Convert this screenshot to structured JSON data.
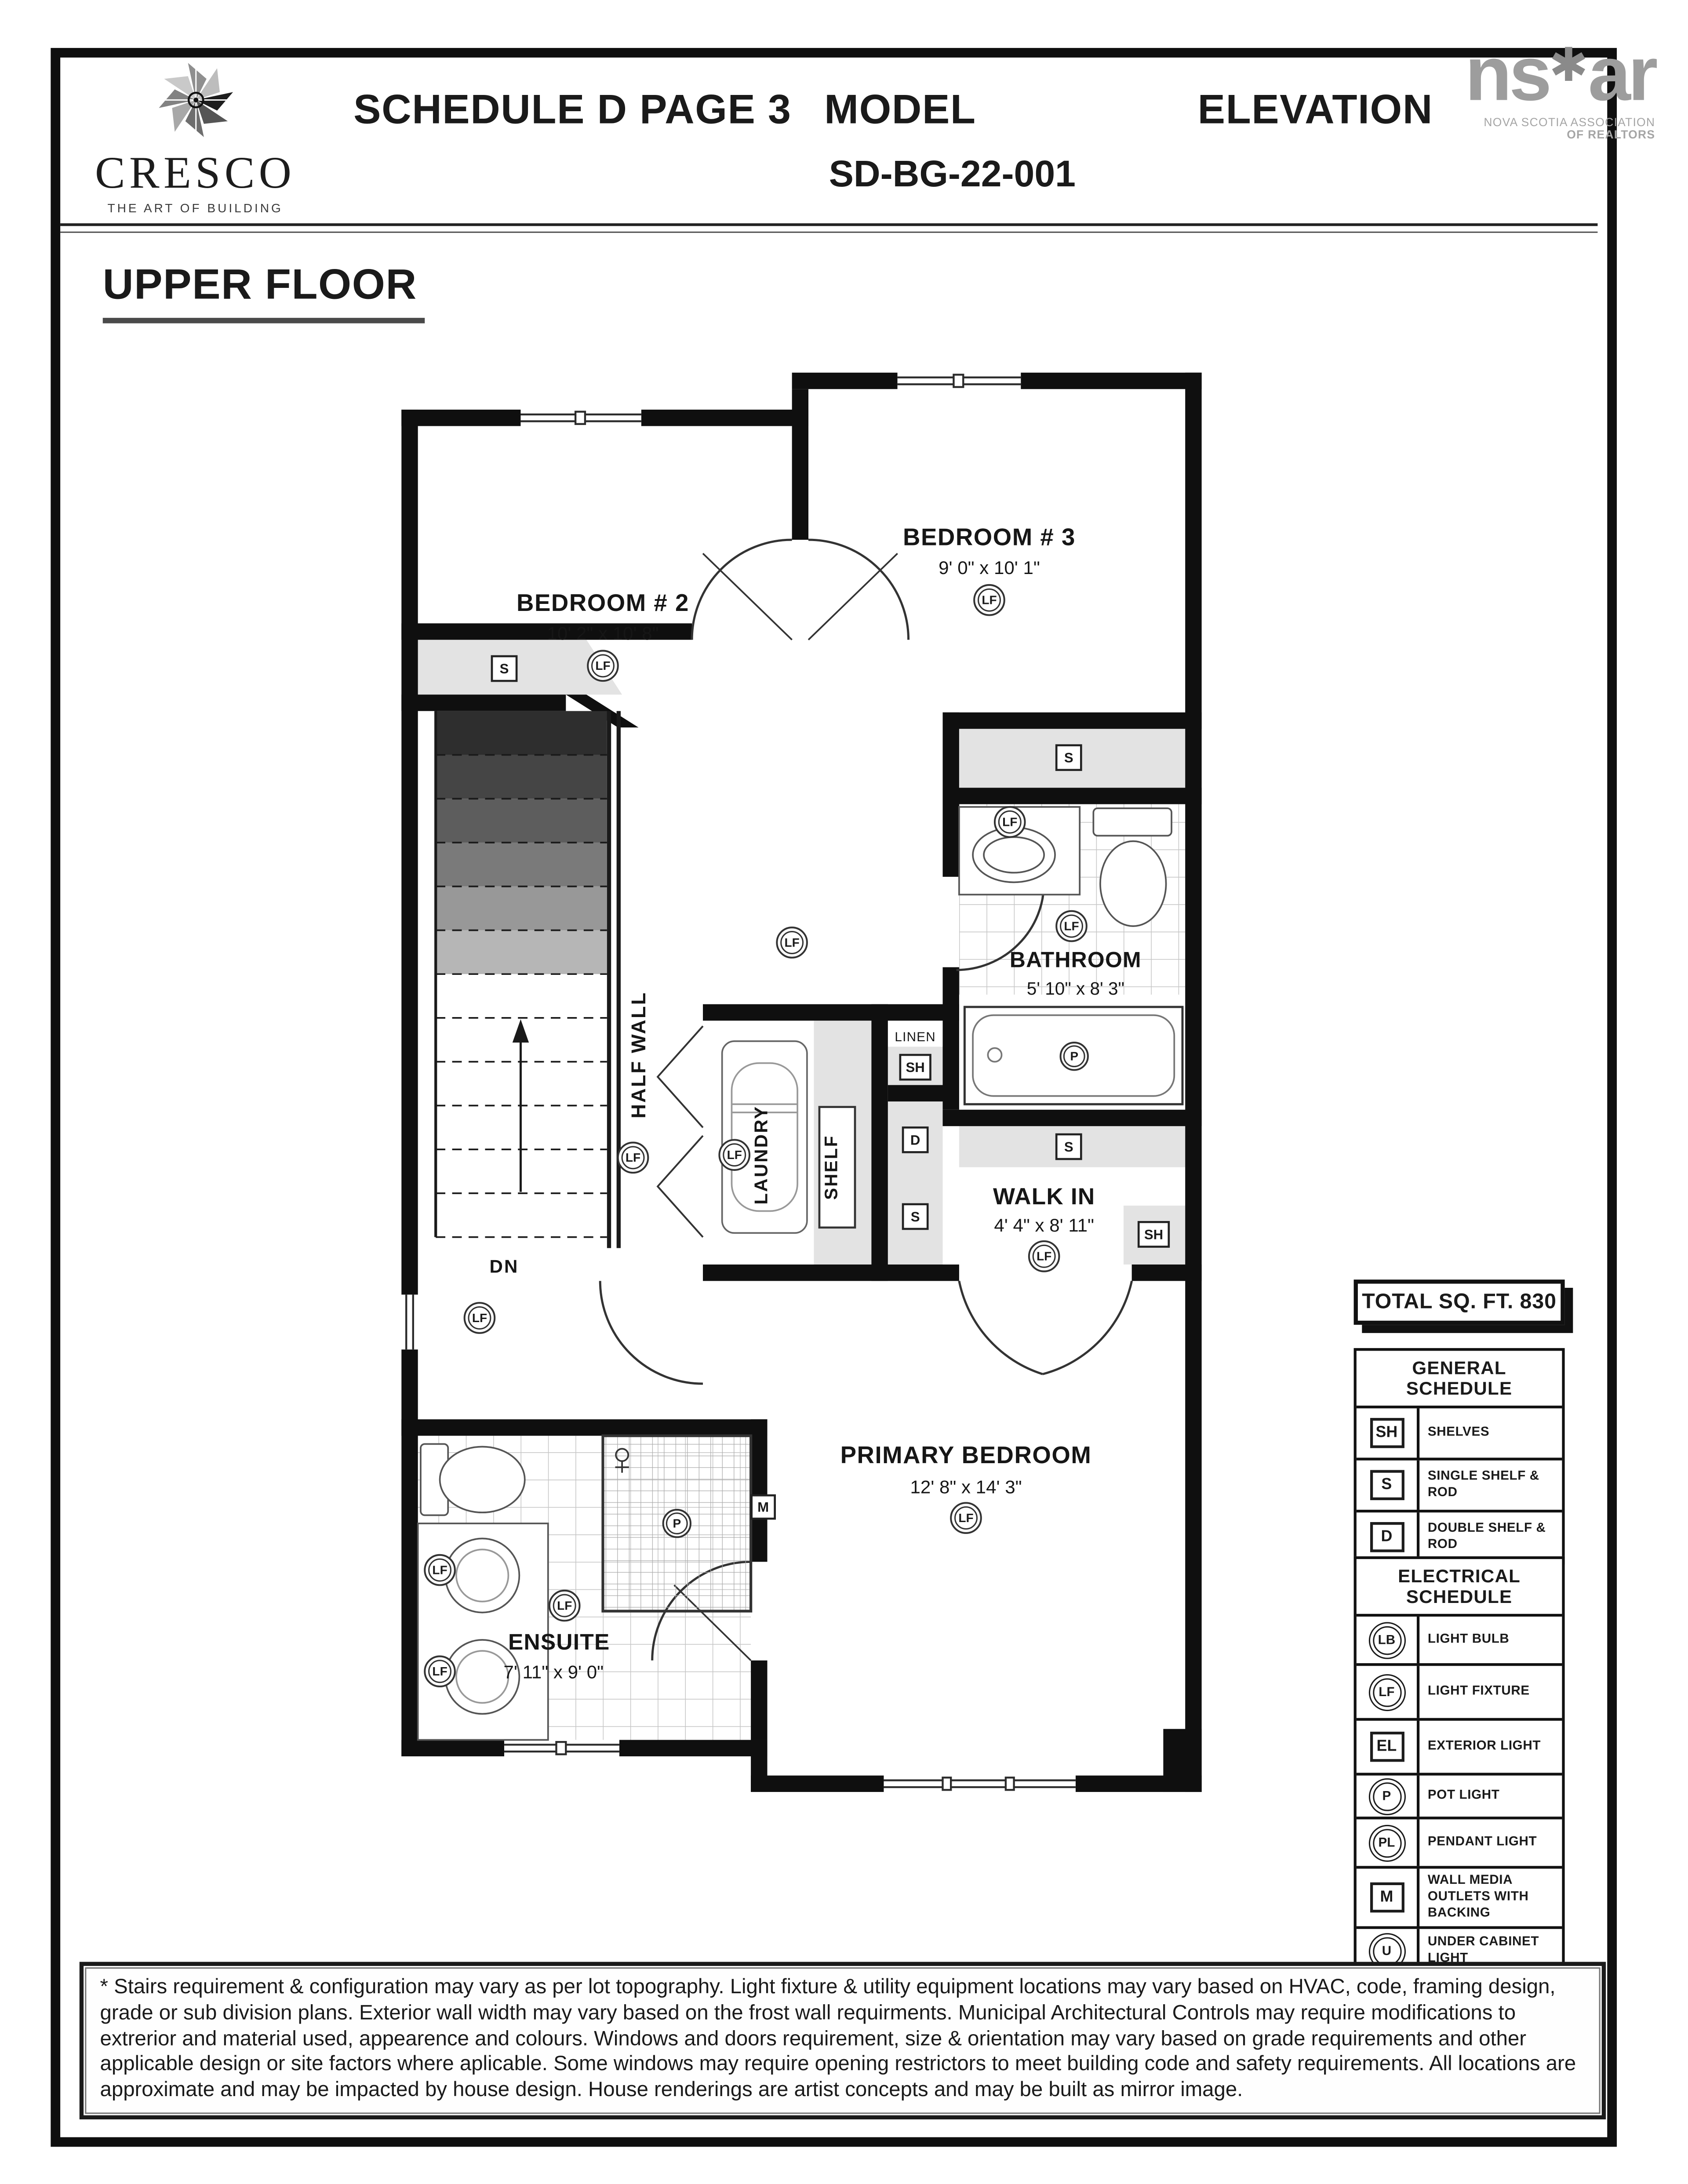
{
  "header": {
    "schedule_title": "SCHEDULE D PAGE 3",
    "model_label": "MODEL",
    "model_number": "SD-BG-22-001",
    "elevation_label": "ELEVATION",
    "brand": {
      "name": "CRESCO",
      "tagline": "THE ART OF BUILDING"
    },
    "nsar": {
      "left": "ns",
      "star": "✱",
      "right": "ar",
      "line1": "NOVA SCOTIA ASSOCIATION",
      "line2": "OF REALTORS"
    }
  },
  "floor_title": "UPPER FLOOR",
  "rooms": {
    "bedroom2": {
      "name": "BEDROOM # 2",
      "dims": "10' 2\" x 10' 8\""
    },
    "bedroom3": {
      "name": "BEDROOM # 3",
      "dims": "9' 0\" x 10' 1\""
    },
    "bathroom": {
      "name": "BATHROOM",
      "dims": "5' 10\" x 8' 3\""
    },
    "walk_in": {
      "name": "WALK IN",
      "dims": "4' 4\" x 8' 11\""
    },
    "primary": {
      "name": "PRIMARY BEDROOM",
      "dims": "12' 8\" x 14' 3\""
    },
    "ensuite": {
      "name": "ENSUITE",
      "dims": "7' 11\" x 9' 0\""
    }
  },
  "plan_labels": {
    "laundry": "LAUNDRY",
    "shelf": "SHELF",
    "linen": "LINEN",
    "half_wall": "HALF WALL",
    "down": "DN"
  },
  "symbols": {
    "lf": "LF",
    "lb": "LB",
    "el": "EL",
    "p": "P",
    "pl": "PL",
    "m": "M",
    "u": "U",
    "s": "S",
    "sh": "SH",
    "d": "D"
  },
  "total_sqft": "TOTAL SQ. FT. 830",
  "general_schedule": {
    "title": "GENERAL SCHEDULE",
    "rows": [
      {
        "symbol": "SH",
        "label": "SHELVES"
      },
      {
        "symbol": "S",
        "label": "SINGLE SHELF & ROD"
      },
      {
        "symbol": "D",
        "label": "DOUBLE SHELF & ROD"
      }
    ]
  },
  "electrical_schedule": {
    "title": "ELECTRICAL SCHEDULE",
    "rows": [
      {
        "symbol": "LB",
        "label": "LIGHT BULB"
      },
      {
        "symbol": "LF",
        "label": "LIGHT FIXTURE"
      },
      {
        "symbol": "EL",
        "label": "EXTERIOR LIGHT"
      },
      {
        "symbol": "P",
        "label": "POT LIGHT"
      },
      {
        "symbol": "PL",
        "label": "PENDANT LIGHT"
      },
      {
        "symbol": "M",
        "label": "WALL MEDIA OUTLETS WITH BACKING"
      },
      {
        "symbol": "U",
        "label": "UNDER CABINET LIGHT"
      }
    ]
  },
  "disclaimer": "* Stairs requirement & configuration may vary as per lot topography. Light fixture & utility equipment locations may vary based on HVAC, code, framing design, grade or sub division plans. Exterior wall width may vary based on the frost wall requirments. Municipal Architectural Controls may require modifications to extrerior and material used, appearence and colours. Windows and doors requirement, size & orientation may vary based on grade requirements and other applicable design or site factors where aplicable. Some windows may require opening restrictors to meet building code and safety requirements. All locations are approximate and may be impacted by house design. House renderings are artist concepts and may be built as mirror image."
}
